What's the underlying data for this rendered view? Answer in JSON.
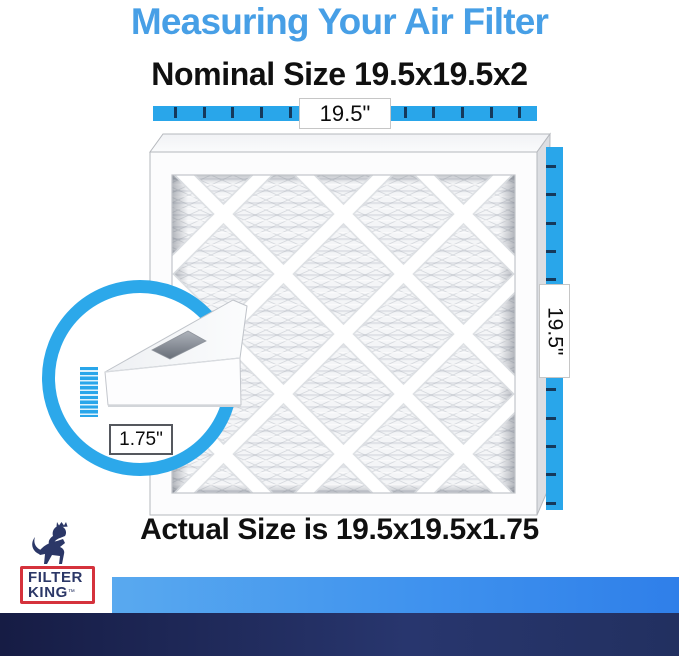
{
  "title": "Measuring Your Air Filter",
  "nominal_heading": "Nominal Size 19.5x19.5x2",
  "actual_heading": "Actual Size is 19.5x19.5x1.75",
  "measurements": {
    "width": "19.5\"",
    "height": "19.5\"",
    "depth": "1.75\""
  },
  "logo": {
    "line1": "FILTER",
    "line2": "KING",
    "trademark": "™"
  },
  "colors": {
    "title_blue": "#479FE6",
    "ruler_blue": "#29A6EA",
    "ring_blue": "#2CA8EA",
    "tick_navy": "#15395B",
    "text_black": "#101010",
    "bar_light_blue_start": "#59A9EF",
    "bar_light_blue_end": "#2F7FE9",
    "bar_navy_start": "#161C44",
    "bar_navy_end": "#28366E",
    "logo_navy": "#2B3767",
    "logo_red": "#D5323C"
  }
}
